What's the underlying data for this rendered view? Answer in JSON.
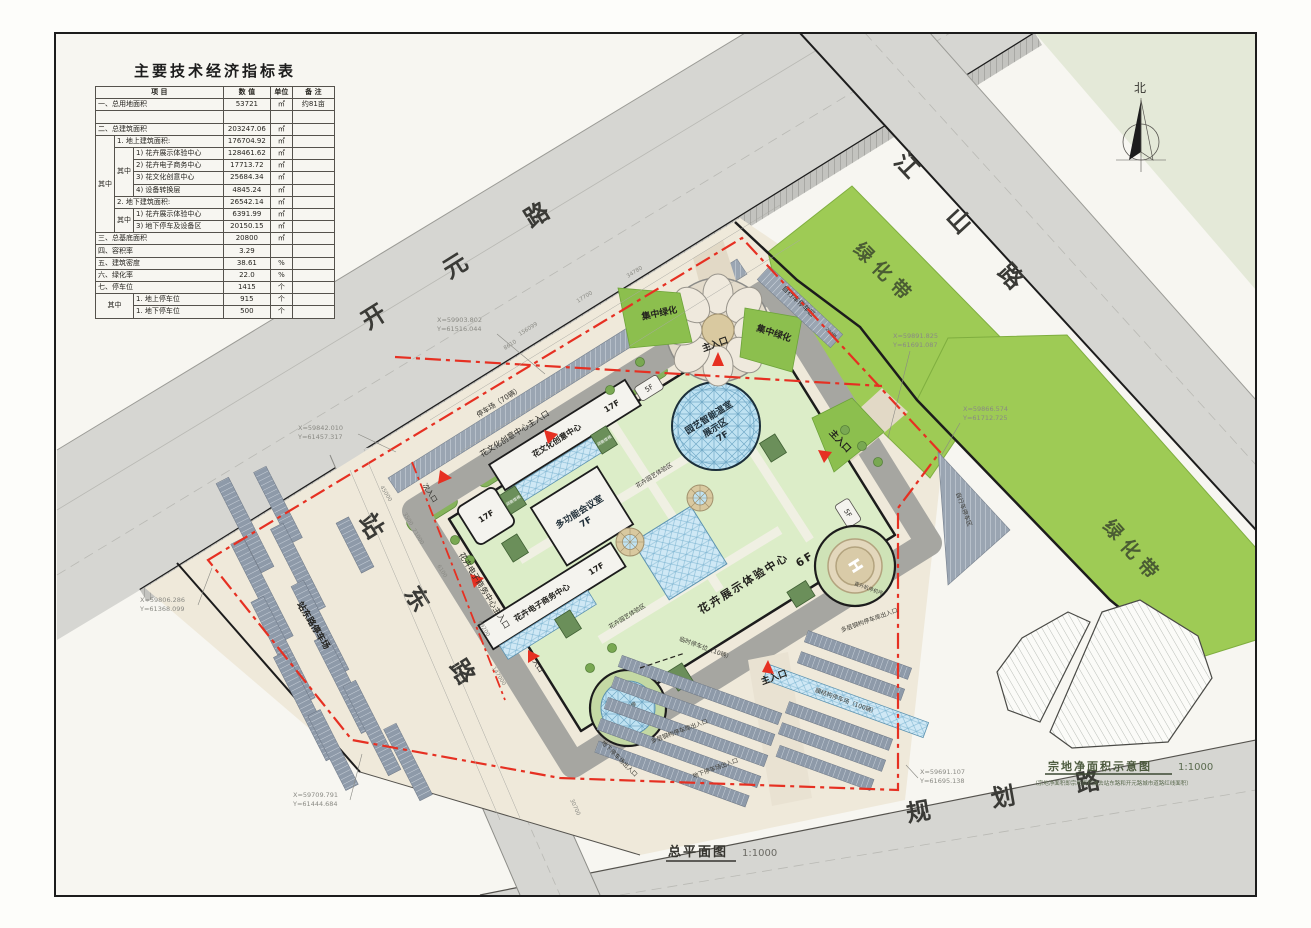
{
  "table": {
    "title": "主要技术经济指标表",
    "headers": {
      "item": "项 目",
      "value": "数 值",
      "unit": "单位",
      "note": "备 注"
    },
    "qizhong": "其中",
    "rows": [
      {
        "item": "一、总用地面积",
        "value": "53721",
        "unit": "㎡",
        "note": "约81亩"
      },
      {
        "item": " ",
        "value": " ",
        "unit": " ",
        "note": " "
      },
      {
        "item": "二、总建筑面积",
        "value": "203247.06",
        "unit": "㎡",
        "note": ""
      },
      {
        "item": "1. 地上建筑面积:",
        "value": "176704.92",
        "unit": "㎡",
        "note": ""
      },
      {
        "item": "1) 花卉展示体验中心",
        "value": "128461.62",
        "unit": "㎡",
        "note": ""
      },
      {
        "item": "2) 花卉电子商务中心",
        "value": "17713.72",
        "unit": "㎡",
        "note": ""
      },
      {
        "item": "3) 花文化创意中心",
        "value": "25684.34",
        "unit": "㎡",
        "note": ""
      },
      {
        "item": "4) 设备转换层",
        "value": "4845.24",
        "unit": "㎡",
        "note": ""
      },
      {
        "item": "2. 地下建筑面积:",
        "value": "26542.14",
        "unit": "㎡",
        "note": ""
      },
      {
        "item": "1) 花卉展示体验中心",
        "value": "6391.99",
        "unit": "㎡",
        "note": ""
      },
      {
        "item": "3) 地下停车及设备区",
        "value": "20150.15",
        "unit": "㎡",
        "note": ""
      },
      {
        "item": "三、总基底面积",
        "value": "20800",
        "unit": "㎡",
        "note": ""
      },
      {
        "item": "四、容积率",
        "value": "3.29",
        "unit": "",
        "note": ""
      },
      {
        "item": "五、建筑密度",
        "value": "38.61",
        "unit": "%",
        "note": ""
      },
      {
        "item": "六、绿化率",
        "value": "22.0",
        "unit": "%",
        "note": ""
      },
      {
        "item": "七、停车位",
        "value": "1415",
        "unit": "个",
        "note": ""
      },
      {
        "item": "1. 地上停车位",
        "value": "915",
        "unit": "个",
        "note": ""
      },
      {
        "item": "1. 地下停车位",
        "value": "500",
        "unit": "个",
        "note": ""
      }
    ]
  },
  "roads": {
    "kaiyuan": "开元路",
    "jiangshan": "江山路",
    "zhandong": "站东路",
    "guihua": "规划路"
  },
  "green": {
    "belt": "绿化带",
    "central": "集中绿化"
  },
  "parking": {
    "west_lot": "站东路停车场",
    "road_strip": "停车场（70辆）",
    "bike": "自行车停车区",
    "bike_cap": "200辆",
    "membrane": "膜结构停车场（100辆）",
    "temp": "临时停车位（10辆）"
  },
  "entrances": {
    "main": "主入口",
    "secondary": "次入口",
    "plain": "入口",
    "creative": "花文化创意中心主入口",
    "ecommerce": "花卉电子商务中心主入口",
    "underground": "地下停车场出入口",
    "garage": "多层钢构停车库出入口"
  },
  "buildings": {
    "greenhouse1": "园艺智能温室",
    "greenhouse2": "展示区",
    "greenhouse_f": "7F",
    "conference": "多功能会议室",
    "conference_f": "7F",
    "creative": "花文化创意中心",
    "creative_f": "17F",
    "ecommerce": "花卉电子商务中心",
    "ecommerce_f": "17F",
    "exhibition": "花卉展示体验中心",
    "exhibition_f": "6F",
    "f17": "17F",
    "f5": "5F",
    "helipad": "直升机停机坪",
    "helipad_h": "H",
    "skylight": "采光天棚",
    "stairs": "疏散楼梯",
    "zone": "花卉园艺体验区"
  },
  "coords": [
    {
      "x": "X=59903.802",
      "y": "Y=61516.044"
    },
    {
      "x": "X=59891.825",
      "y": "Y=61691.087"
    },
    {
      "x": "X=59866.574",
      "y": "Y=61712.725"
    },
    {
      "x": "X=59842.010",
      "y": "Y=61457.317"
    },
    {
      "x": "X=59806.286",
      "y": "Y=61368.099"
    },
    {
      "x": "X=59709.791",
      "y": "Y=61444.684"
    },
    {
      "x": "X=59691.107",
      "y": "Y=61695.138"
    }
  ],
  "dims": [
    "17700",
    "34780",
    "8610",
    "156099",
    "45000",
    "3500",
    "21000",
    "6100",
    "69200",
    "147000",
    "30700"
  ],
  "north": "北",
  "titles": {
    "master": "总平面图",
    "master_scale": "1:1000",
    "parcel": "宗地净面积示意图",
    "parcel_scale": "1:1000",
    "parcel_note": "（宗地净面积即宗地面积减去站东路和开元路城市道路红线面积）"
  }
}
